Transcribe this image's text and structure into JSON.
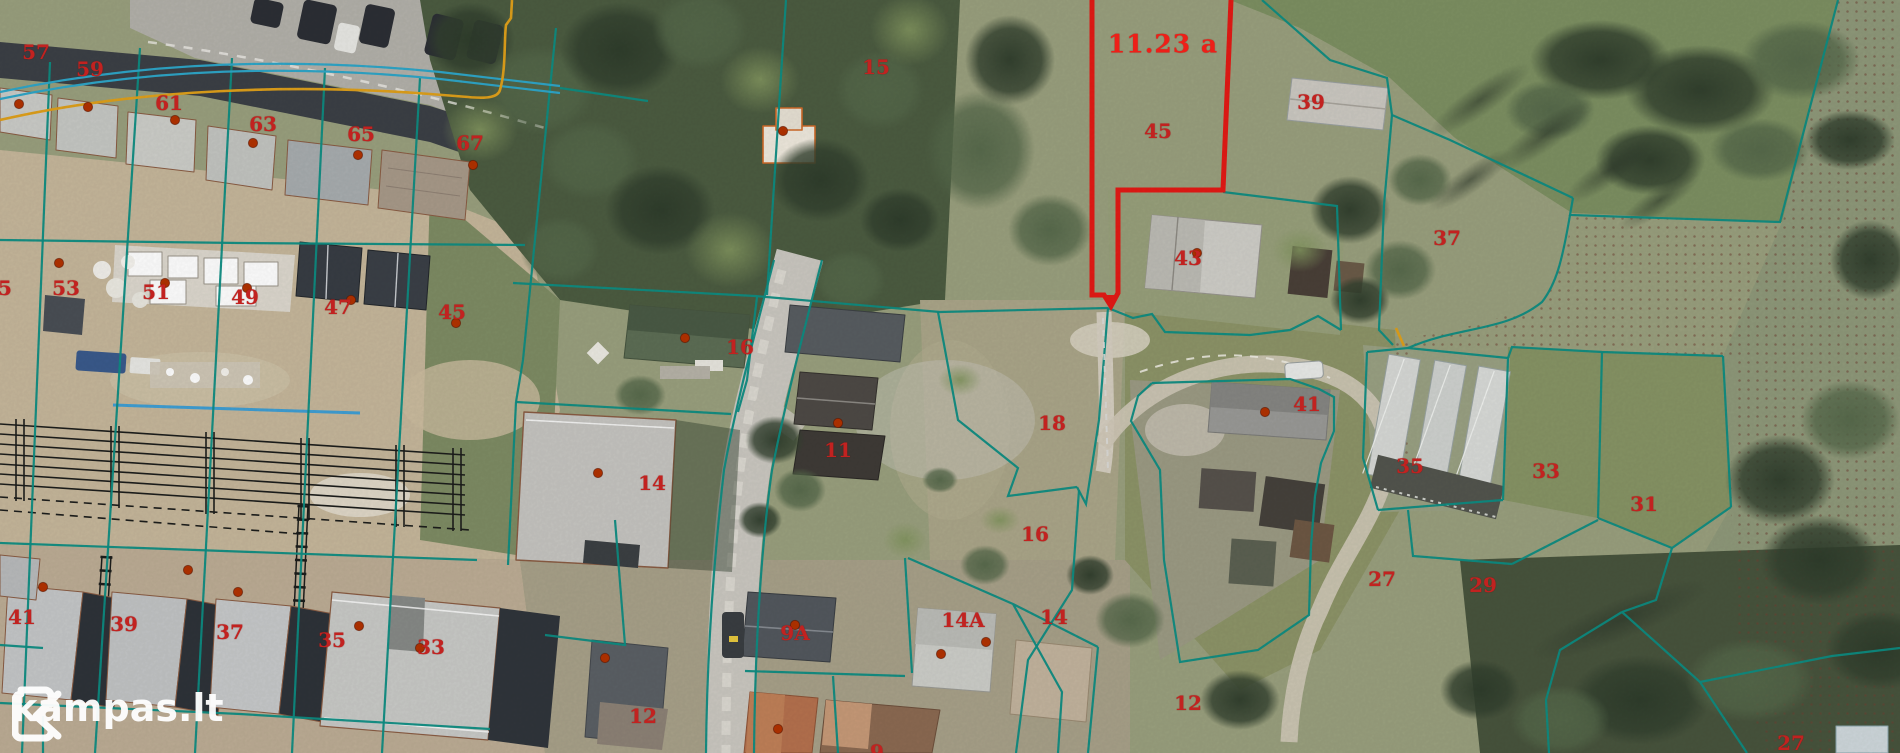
{
  "branding": {
    "logo_text": "kampas.lt"
  },
  "map": {
    "colors": {
      "boundary": "#0d8d83",
      "boundary_blue": "#2fa6c8",
      "orange_line": "#dfa01b",
      "highlight_red": "#e41a15",
      "label_red": "#c22220",
      "label_bright_red": "#ee1f18",
      "marker_dot": "#b23200",
      "logo_white": "#ffffff"
    },
    "highlight": {
      "area_label": "11.23 a",
      "parcel_number": "45"
    },
    "labels": [
      {
        "t": "57",
        "x": 36,
        "y": 52
      },
      {
        "t": "59",
        "x": 90,
        "y": 69
      },
      {
        "t": "61",
        "x": 169,
        "y": 103
      },
      {
        "t": "63",
        "x": 263,
        "y": 124
      },
      {
        "t": "65",
        "x": 361,
        "y": 134
      },
      {
        "t": "67",
        "x": 470,
        "y": 143
      },
      {
        "t": "5",
        "x": 5,
        "y": 288
      },
      {
        "t": "53",
        "x": 66,
        "y": 288
      },
      {
        "t": "51",
        "x": 156,
        "y": 292
      },
      {
        "t": "49",
        "x": 245,
        "y": 297
      },
      {
        "t": "47",
        "x": 338,
        "y": 307
      },
      {
        "t": "45",
        "x": 452,
        "y": 312
      },
      {
        "t": "15",
        "x": 876,
        "y": 67
      },
      {
        "t": "16",
        "x": 740,
        "y": 347
      },
      {
        "t": "45",
        "x": 1158,
        "y": 131
      },
      {
        "t": "39",
        "x": 1311,
        "y": 102
      },
      {
        "t": "37",
        "x": 1447,
        "y": 238
      },
      {
        "t": "43",
        "x": 1188,
        "y": 258
      },
      {
        "t": "41",
        "x": 1307,
        "y": 404
      },
      {
        "t": "18",
        "x": 1052,
        "y": 423
      },
      {
        "t": "16",
        "x": 1035,
        "y": 534
      },
      {
        "t": "35",
        "x": 1410,
        "y": 466
      },
      {
        "t": "33",
        "x": 1546,
        "y": 471
      },
      {
        "t": "31",
        "x": 1644,
        "y": 504
      },
      {
        "t": "29",
        "x": 1483,
        "y": 585
      },
      {
        "t": "27",
        "x": 1382,
        "y": 579
      },
      {
        "t": "41",
        "x": 22,
        "y": 617
      },
      {
        "t": "39",
        "x": 124,
        "y": 624
      },
      {
        "t": "37",
        "x": 230,
        "y": 632
      },
      {
        "t": "35",
        "x": 332,
        "y": 640
      },
      {
        "t": "33",
        "x": 431,
        "y": 647
      },
      {
        "t": "12",
        "x": 643,
        "y": 716
      },
      {
        "t": "11",
        "x": 838,
        "y": 450
      },
      {
        "t": "14",
        "x": 652,
        "y": 483
      },
      {
        "t": "9A",
        "x": 795,
        "y": 633
      },
      {
        "t": "14A",
        "x": 963,
        "y": 620
      },
      {
        "t": "14",
        "x": 1054,
        "y": 617
      },
      {
        "t": "12",
        "x": 1188,
        "y": 703
      },
      {
        "t": "27",
        "x": 1791,
        "y": 743
      },
      {
        "t": "9",
        "x": 877,
        "y": 752
      }
    ],
    "highlight_label": {
      "t": "11.23 a",
      "x": 1163,
      "y": 44
    },
    "dots": [
      [
        19,
        104
      ],
      [
        88,
        107
      ],
      [
        175,
        120
      ],
      [
        253,
        143
      ],
      [
        358,
        155
      ],
      [
        473,
        165
      ],
      [
        59,
        263
      ],
      [
        165,
        283
      ],
      [
        247,
        288
      ],
      [
        351,
        300
      ],
      [
        456,
        323
      ],
      [
        783,
        131
      ],
      [
        685,
        338
      ],
      [
        838,
        423
      ],
      [
        598,
        473
      ],
      [
        1197,
        253
      ],
      [
        1265,
        412
      ],
      [
        795,
        625
      ],
      [
        941,
        654
      ],
      [
        986,
        642
      ],
      [
        605,
        658
      ],
      [
        778,
        729
      ],
      [
        43,
        587
      ],
      [
        188,
        570
      ],
      [
        238,
        592
      ],
      [
        359,
        626
      ],
      [
        420,
        648
      ]
    ]
  }
}
